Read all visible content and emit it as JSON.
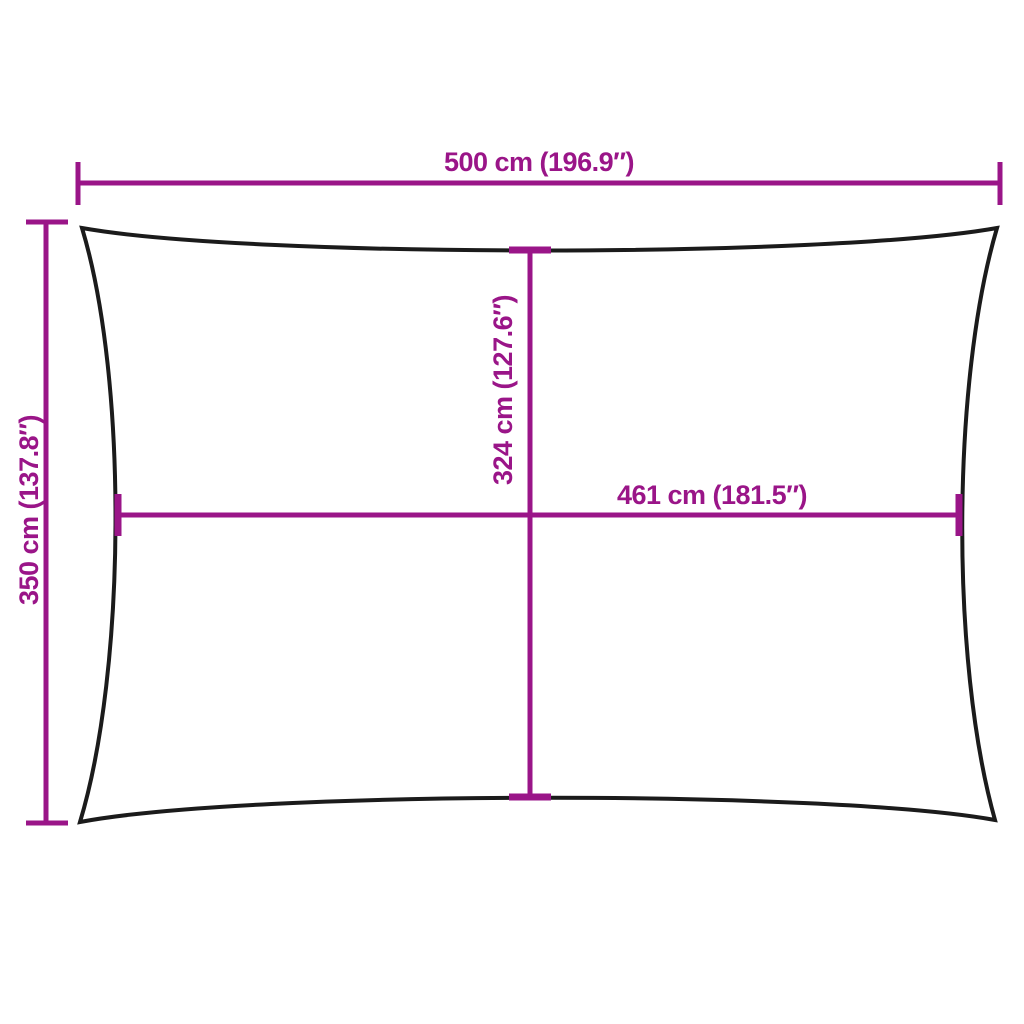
{
  "diagram": {
    "kind": "product-dimension-diagram",
    "shape": "rectangle-shade-sail",
    "labels": {
      "top": "500 cm (196.9″)",
      "left": "350 cm (137.8″)",
      "inner_vertical": "324 cm (127.6″)",
      "inner_horizontal": "461 cm (181.5″)"
    },
    "dimensions": {
      "overall_width_cm": 500,
      "overall_width_in": 196.9,
      "overall_height_cm": 350,
      "overall_height_in": 137.8,
      "inner_height_cm": 324,
      "inner_height_in": 127.6,
      "inner_width_cm": 461,
      "inner_width_in": 181.5,
      "metric_unit": "cm",
      "imperial_unit": "″"
    },
    "colors": {
      "accent": "#9A1588",
      "outline": "#1B1B1B",
      "background": "#FFFFFF"
    }
  }
}
